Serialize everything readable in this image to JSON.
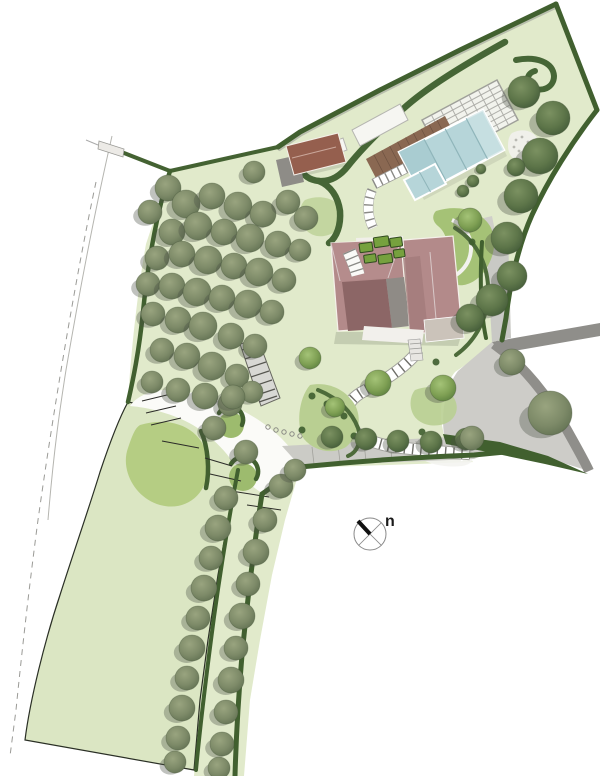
{
  "meta": {
    "type": "landscape-site-plan",
    "canvas_width": 600,
    "canvas_height": 776
  },
  "compass": {
    "label": "n"
  },
  "palette": {
    "background": "#ffffff",
    "ground": "#e1eacb",
    "lawn": "#dbe6c3",
    "lawn_bright": "#aec878",
    "lawn_circle": "#9dbb6e",
    "hedge": "#41602f",
    "hedge_light": "#4d6b3a",
    "bed": "#b9cf92",
    "bed_bright": "#a5c276",
    "bed_pale": "#c3d6a0",
    "tree_olive": "#7d8a68",
    "tree_dark": "#5d7549",
    "tree_garden": "#7fa054",
    "tree_shadow": "#4a4f45",
    "tree_stroke": "#435238",
    "water": "#b6d5d9",
    "water_dark": "#a9ccd1",
    "water_light": "#cde2e4",
    "deck": "#8a6852",
    "deck_line": "#6d5140",
    "pergola": "#f4f4f0",
    "roof_pink": "#b38a8a",
    "roof_pink_light": "#b58c8c",
    "roof_pink_dark": "#8c6666",
    "roof_gray": "#8f8b86",
    "roof_flat": "#cbc3ba",
    "garage_roof": "#955f4e",
    "garage_gray": "#8e8c87",
    "white_surface": "#f2f0ec",
    "white_path": "#fbfbf8",
    "driveway": "#cdccc8",
    "road": "#8f8e8a",
    "terrace_strip": "#cbcbc6",
    "boardwalk": "#d8d8d4",
    "contour": "#9a9a96",
    "compass_ring": "#8a8a8a",
    "needle": "#111111"
  },
  "courtyard": {
    "planter_fill": "#76a13e",
    "planter_stroke": "#2f4a1e",
    "planters": [
      [
        360,
        241,
        13,
        9
      ],
      [
        375,
        237,
        15,
        10
      ],
      [
        391,
        240,
        12,
        9
      ],
      [
        363,
        253,
        12,
        8
      ],
      [
        377,
        255,
        14,
        9
      ],
      [
        393,
        252,
        11,
        8
      ]
    ]
  },
  "tree_groups": [
    {
      "name": "olive-grove",
      "style": "olive",
      "trees": [
        [
          168,
          188,
          13
        ],
        [
          150,
          212,
          12
        ],
        [
          186,
          204,
          14
        ],
        [
          212,
          196,
          13
        ],
        [
          238,
          206,
          14
        ],
        [
          263,
          214,
          13
        ],
        [
          288,
          202,
          12
        ],
        [
          306,
          218,
          12
        ],
        [
          172,
          232,
          13
        ],
        [
          198,
          226,
          14
        ],
        [
          224,
          232,
          13
        ],
        [
          250,
          238,
          14
        ],
        [
          278,
          244,
          13
        ],
        [
          300,
          250,
          11
        ],
        [
          157,
          258,
          12
        ],
        [
          182,
          254,
          13
        ],
        [
          208,
          260,
          14
        ],
        [
          234,
          266,
          13
        ],
        [
          259,
          272,
          14
        ],
        [
          284,
          280,
          12
        ],
        [
          148,
          284,
          12
        ],
        [
          172,
          286,
          13
        ],
        [
          197,
          292,
          14
        ],
        [
          222,
          298,
          13
        ],
        [
          248,
          304,
          14
        ],
        [
          272,
          312,
          12
        ],
        [
          153,
          314,
          12
        ],
        [
          178,
          320,
          13
        ],
        [
          203,
          326,
          14
        ],
        [
          231,
          336,
          13
        ],
        [
          255,
          346,
          12
        ],
        [
          162,
          350,
          12
        ],
        [
          187,
          356,
          13
        ],
        [
          212,
          366,
          14
        ],
        [
          237,
          376,
          12
        ],
        [
          152,
          382,
          11
        ],
        [
          178,
          390,
          12
        ],
        [
          205,
          396,
          13
        ],
        [
          230,
          404,
          12
        ],
        [
          252,
          392,
          11
        ],
        [
          254,
          172,
          11
        ],
        [
          233,
          397,
          12
        ],
        [
          214,
          428,
          12
        ],
        [
          246,
          452,
          12
        ],
        [
          281,
          486,
          12
        ],
        [
          295,
          470,
          11
        ]
      ]
    },
    {
      "name": "tree-allee",
      "style": "olive",
      "trees": [
        [
          226,
          498,
          12
        ],
        [
          218,
          528,
          13
        ],
        [
          211,
          558,
          12
        ],
        [
          204,
          588,
          13
        ],
        [
          198,
          618,
          12
        ],
        [
          192,
          648,
          13
        ],
        [
          187,
          678,
          12
        ],
        [
          182,
          708,
          13
        ],
        [
          178,
          738,
          12
        ],
        [
          175,
          762,
          11
        ],
        [
          265,
          520,
          12
        ],
        [
          256,
          552,
          13
        ],
        [
          248,
          584,
          12
        ],
        [
          242,
          616,
          13
        ],
        [
          236,
          648,
          12
        ],
        [
          231,
          680,
          13
        ],
        [
          226,
          712,
          12
        ],
        [
          222,
          744,
          12
        ],
        [
          219,
          768,
          11
        ]
      ]
    },
    {
      "name": "east-boundary-trees",
      "style": "dark",
      "trees": [
        [
          524,
          92,
          16
        ],
        [
          553,
          118,
          17
        ],
        [
          540,
          156,
          18
        ],
        [
          521,
          196,
          17
        ],
        [
          507,
          238,
          16
        ],
        [
          512,
          276,
          15
        ],
        [
          492,
          300,
          16
        ],
        [
          470,
          318,
          14
        ]
      ]
    },
    {
      "name": "garden-trees",
      "style": "garden",
      "trees": [
        [
          310,
          358,
          11
        ],
        [
          378,
          383,
          13
        ],
        [
          443,
          388,
          13
        ],
        [
          335,
          407,
          10
        ],
        [
          470,
          220,
          12
        ]
      ]
    },
    {
      "name": "terrace-row-trees",
      "style": "dark",
      "trees": [
        [
          332,
          437,
          11
        ],
        [
          366,
          439,
          11
        ],
        [
          398,
          441,
          11
        ],
        [
          431,
          442,
          11
        ],
        [
          466,
          439,
          11
        ]
      ]
    },
    {
      "name": "driveway-trees",
      "style": "olive",
      "trees": [
        [
          550,
          413,
          22
        ],
        [
          512,
          362,
          13
        ],
        [
          472,
          438,
          12
        ]
      ]
    },
    {
      "name": "pool-shrubs",
      "style": "dark",
      "trees": [
        [
          473,
          181,
          6
        ],
        [
          481,
          169,
          5
        ],
        [
          463,
          191,
          6
        ],
        [
          516,
          167,
          9
        ]
      ]
    }
  ]
}
